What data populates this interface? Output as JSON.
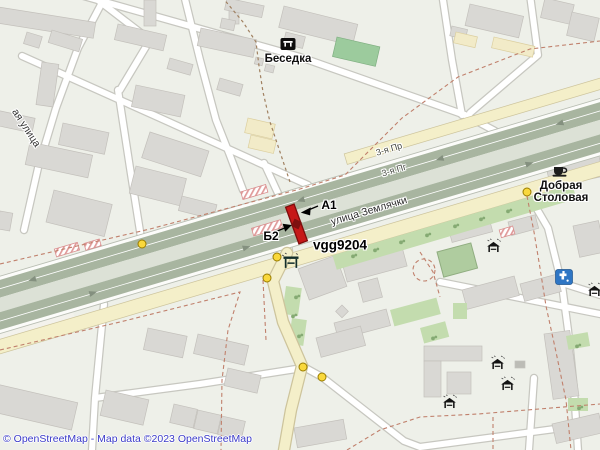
{
  "map": {
    "attribution": "© OpenStreetMap - Map data ©2023 OpenStreetMap",
    "labels": {
      "gazebo_poi": "Беседка",
      "frontage_road": "3-я Пр",
      "carriageway_road": "3-я Пг",
      "main_street": "улица Землячки",
      "left_street": "ая улица",
      "stop_a": "А1",
      "stop_b": "Б2",
      "marker_id": "vgg9204",
      "cafe_poi_line1": "Добрая",
      "cafe_poi_line2": "Столовая"
    },
    "colors": {
      "carriageway_green": "#a8b5a0",
      "road_median": "#dce1d6",
      "road_yellow": "#f4efc9",
      "building_gray": "#d9d8d4",
      "green_area": "#c3dcae",
      "marker_red": "#c61818",
      "signal_yellow": "#f9d83c",
      "water_icon_blue": "#2f76c4",
      "boundary_dash_red": "#c0806c",
      "attribution_blue": "#3a3ac8"
    },
    "icons": [
      "picnic-shelter-icon",
      "bus-shelter-icon",
      "cafe-icon",
      "drinking-water-icon",
      "traffic-signal-dot",
      "level-crossing-marker",
      "tree-icon"
    ]
  }
}
